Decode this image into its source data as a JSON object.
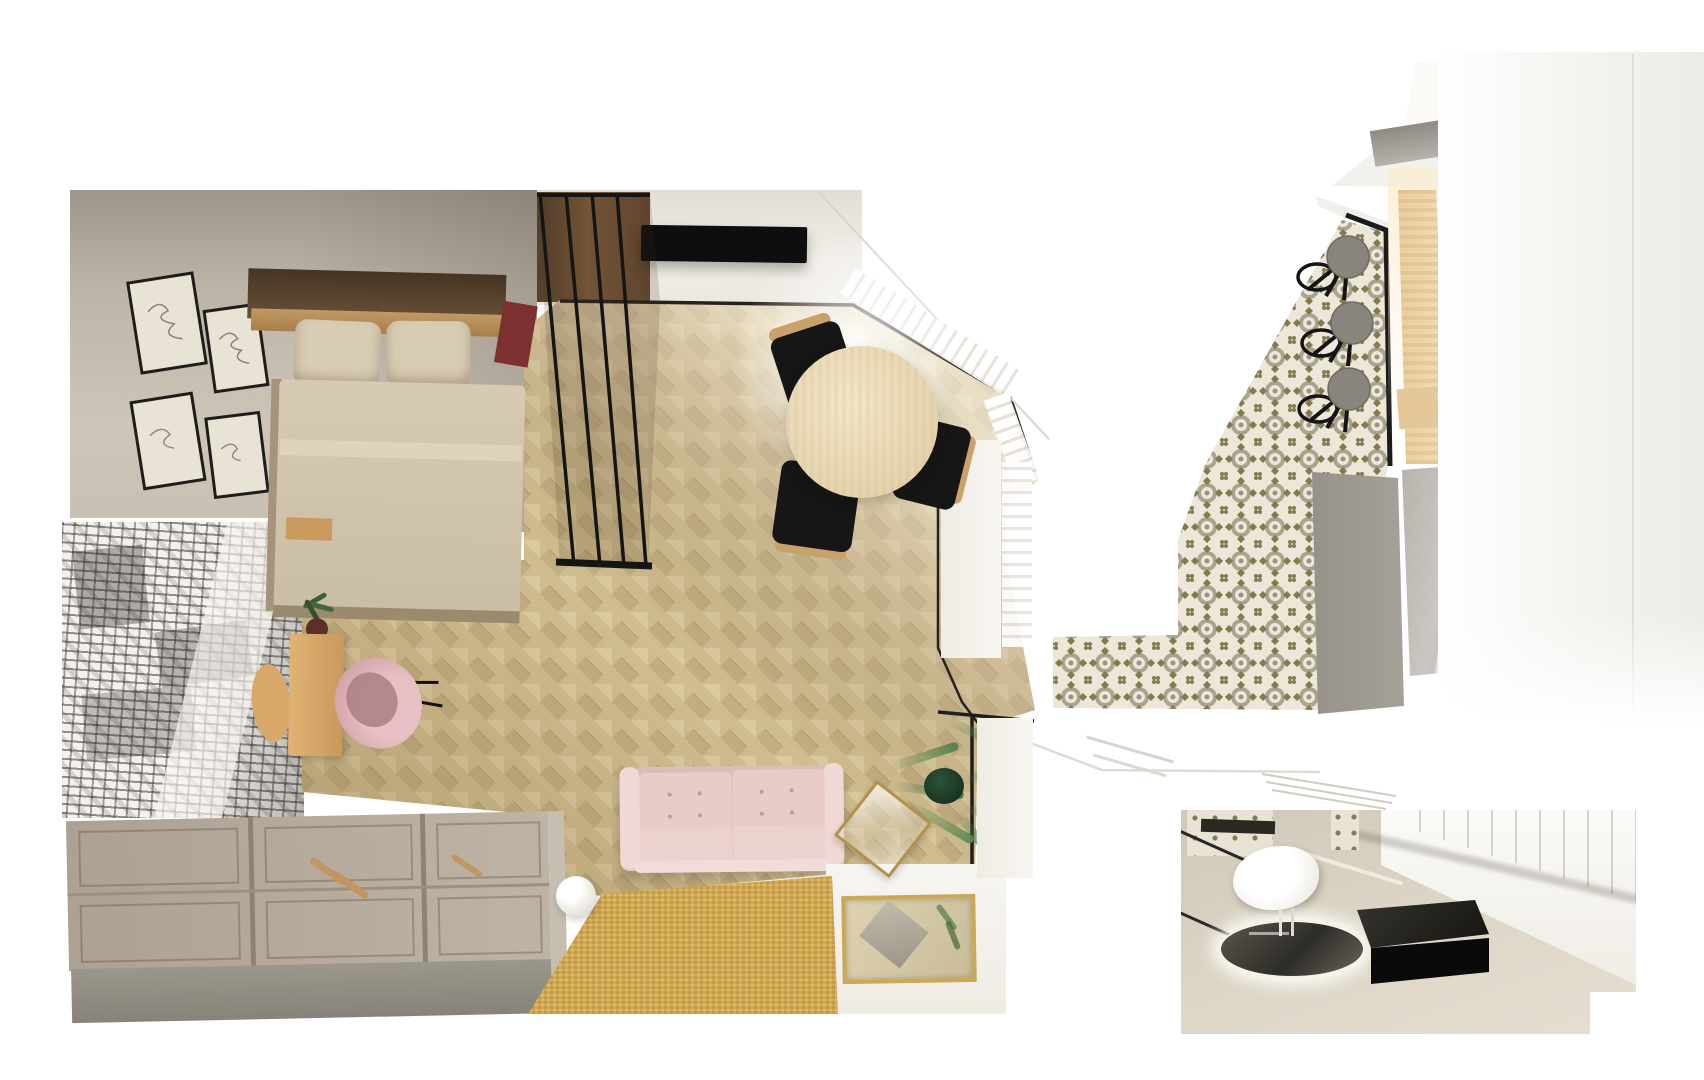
{
  "page": {
    "kind": "interior-design-render",
    "description": "Top-down 3D render of a studio apartment with two additional perspective views (kitchen hallway, bathroom inset). No text is rendered in the image."
  },
  "colors": {
    "page_bg": "#ffffff",
    "wall_beige": "#c9c1b5",
    "wall_dark": "#a19889",
    "wall_white": "#efece6",
    "floor_base": "#d0bd90",
    "plank_light": "#dccaa0",
    "plank_dark": "#c2ae82",
    "rug_yellow": "#d2a851",
    "sofa_pink": "#e5c6c3",
    "sofa_pink_light": "#efd8d5",
    "table_wood": "#ecdcba",
    "chair_black": "#161616",
    "chair_wood": "#c8a26a",
    "headboard_wood": "#5d4730",
    "shelf_wood": "#b98e55",
    "pillow_beige": "#d9ccb4",
    "duvet_beige": "#d1c5ad",
    "maroon_accent": "#7d3030",
    "wardrobe_top": "#b2a798",
    "wardrobe_front": "#928d81",
    "mural_paper": "#f4f1ec",
    "mural_ink": "#2e2b28",
    "partition_black": "#151515",
    "tv_black": "#0e0e0e",
    "tile_base": "#ece7d9",
    "tile_olive": "#837b4e",
    "tile_gray": "#aaa390",
    "stool_gray": "#8a857c",
    "panel_gray": "#a6a29a",
    "panel_gray_light": "#bab7b0",
    "wood_panel": "#eed3a4",
    "gold_frame": "#c9a856",
    "plant_green": "#4c7a45",
    "plant_dark": "#1f3c2a",
    "glass_tint": "rgba(70,45,25,0.16)",
    "white_floor": "#f4f1ea",
    "inset_floor": "#d5cebe",
    "bench_black": "#111111",
    "mirror_dark": "#45423b"
  },
  "scene": {
    "views": [
      {
        "id": "studio-top-view",
        "label": "studio apartment top-down view",
        "objects": [
          "bedroom wall with four framed prints",
          "black and white city mural wallpaper",
          "double bed with wood headboard shelf, two pillows, beige duvet, maroon cushion",
          "black framed glass partition",
          "wall mounted tv on white wall",
          "herringbone parquet floor",
          "round wooden dining table",
          "three black dining chairs with wood backs",
          "corner window with light and radiator slats",
          "wooden desk with stool and pink egg chair",
          "small desk plant",
          "storage wardrobe with panel doors and wood handles",
          "pink tufted two-seat sofa",
          "yellow textured rug",
          "white sphere floor lamp",
          "potted palm plant",
          "gold framed glass coffee table",
          "gold framed floor mirror tray",
          "black framed glass wall of bathroom"
        ]
      },
      {
        "id": "kitchen-view",
        "label": "kitchen hallway perspective view",
        "objects": [
          "white ceiling planes with gray skylight",
          "patterned cement tile floor",
          "black bar counter edge",
          "three round gray bar stools with black legs",
          "light wood wall panel",
          "gray cabinet panels",
          "bright white wall with window light",
          "floor drain lines"
        ]
      },
      {
        "id": "bathroom-inset",
        "label": "bathroom inset view",
        "objects": [
          "round backlit mirror lying flat",
          "white cloud shaped stool",
          "black rectangular bench",
          "glass shower screen lines",
          "paneled white wall",
          "patterned tile accents"
        ]
      }
    ]
  }
}
